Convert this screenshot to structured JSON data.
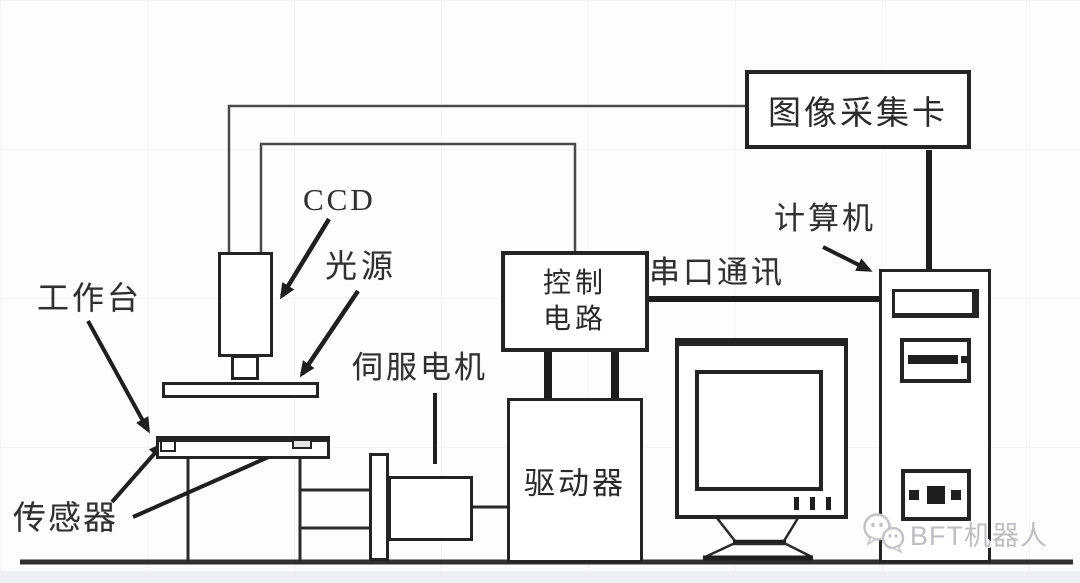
{
  "diagram": {
    "nodes": {
      "capture_card": "图像采集卡",
      "control_line1": "控制",
      "control_line2": "电路",
      "driver": "驱动器",
      "computer": "计算机",
      "ccd": "CCD",
      "light_source": "光源",
      "worktable": "工作台",
      "sensor": "传感器",
      "servo_motor": "伺服电机"
    },
    "connection_labels": {
      "serial_comm": "串口通讯"
    }
  },
  "watermark": {
    "text": "BFT机器人",
    "icon": "wechat-bubbles-icon",
    "color": "#bdbec2"
  },
  "colors": {
    "line": "#2a2a2a",
    "thick_link": "#1c1c1c",
    "wire": "#4a4a4a",
    "background": "#fdfdfe"
  }
}
